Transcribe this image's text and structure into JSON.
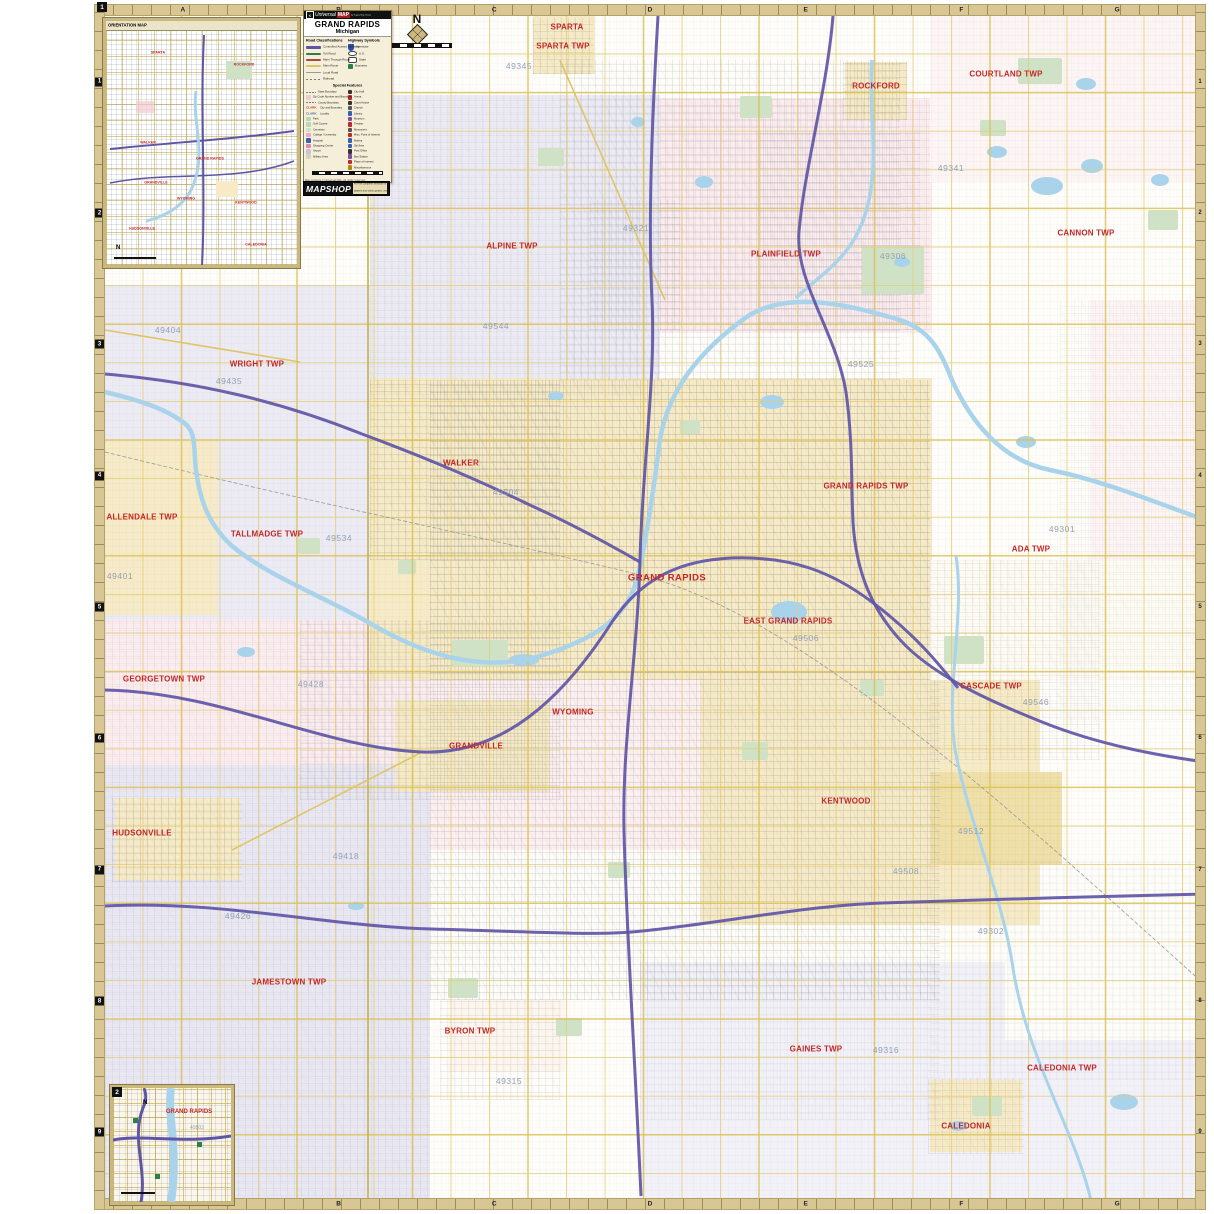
{
  "sheet": {
    "title": "GRAND RAPIDS",
    "subtitle": "Michigan",
    "brand": {
      "k": "K",
      "name": "Universal",
      "map": "MAP",
      "tag": "by Kappa Map Group"
    },
    "north_letter": "N",
    "grid": {
      "letters": [
        "A",
        "B",
        "C",
        "D",
        "E",
        "F",
        "G"
      ],
      "numbers": [
        "1",
        "2",
        "3",
        "4",
        "5",
        "6",
        "7",
        "8",
        "9"
      ]
    },
    "legend": {
      "roads_header": "Road Classifications",
      "symbols_header": "Highway Symbols",
      "roads": [
        {
          "label": "Controlled Access Highway",
          "color": "#5f55a6",
          "w": 3
        },
        {
          "label": "Toll Road",
          "color": "#2e7d4f",
          "w": 2
        },
        {
          "label": "Main Through Route",
          "color": "#a84b3c",
          "w": 2
        },
        {
          "label": "Main Route",
          "color": "#dfc566",
          "w": 2
        },
        {
          "label": "Local Road",
          "color": "#9a9a9a",
          "w": 1
        },
        {
          "label": "Railroad",
          "color": "#777777",
          "w": 1,
          "dash": true
        }
      ],
      "symbols": [
        {
          "label": "Interstate",
          "type": "shield"
        },
        {
          "label": "U.S.",
          "type": "oval"
        },
        {
          "label": "State",
          "type": "rect"
        },
        {
          "label": "Business",
          "type": "square"
        }
      ],
      "special_header": "Special Features",
      "special_left": [
        {
          "t": "State Boundary",
          "chip": "dash"
        },
        {
          "t": "Zip Code Number and Boundary",
          "chip": "#f3c9d3"
        },
        {
          "t": "County Boundary",
          "chip": "dash"
        },
        {
          "t": "City and Boundary",
          "chip": "text:#c42727:CLARK"
        },
        {
          "t": "Locality",
          "chip": "text:#3a5fae:CLARK"
        },
        {
          "t": "Park",
          "chip": "#b9d7ae"
        },
        {
          "t": "Golf Course",
          "chip": "#b9d7ae"
        },
        {
          "t": "Cemetery",
          "chip": "#cfe0c8"
        },
        {
          "t": "College / University",
          "chip": "#f0a7c3"
        },
        {
          "t": "Hospital",
          "chip": "#3a5fae"
        },
        {
          "t": "Shopping Center",
          "chip": "#e08aa8"
        },
        {
          "t": "Airport",
          "chip": "#c9bfe0"
        },
        {
          "t": "Military Area",
          "chip": "#d8d3b8"
        }
      ],
      "special_right": [
        {
          "t": "City Hall",
          "chip": "#333333"
        },
        {
          "t": "Arena",
          "chip": "#c42727"
        },
        {
          "t": "Court House",
          "chip": "#333333"
        },
        {
          "t": "Church",
          "chip": "#555555"
        },
        {
          "t": "Library",
          "chip": "#3a5fae"
        },
        {
          "t": "Museum",
          "chip": "#7a4fa0"
        },
        {
          "t": "Theater",
          "chip": "#c42727"
        },
        {
          "t": "Monument",
          "chip": "#555555"
        },
        {
          "t": "Misc. Point of Interest",
          "chip": "#c42727"
        },
        {
          "t": "Marina",
          "chip": "#3a5fae"
        },
        {
          "t": "Ski Area",
          "chip": "#3a5fae"
        },
        {
          "t": "Post Office",
          "chip": "#333333"
        },
        {
          "t": "Bus Station",
          "chip": "#7a4fa0"
        },
        {
          "t": "Place of Interest",
          "chip": "#c42727"
        },
        {
          "t": "Miscellaneous",
          "chip": "#b5890f"
        }
      ],
      "copyright": "Map contents © Universal Map. All rights reserved."
    },
    "mapshop": {
      "name": "MAPSHOP",
      "lines": [
        "For the complete selection of maps,",
        "atlases and travel guides, visit",
        "your local MapShop dealer."
      ]
    },
    "insets": {
      "orientation": {
        "tab": "1",
        "header": "ORIENTATION MAP",
        "labels": [
          {
            "t": "SPARTA",
            "x": 52,
            "y": 22
          },
          {
            "t": "ROCKFORD",
            "x": 138,
            "y": 34
          },
          {
            "t": "WALKER",
            "x": 42,
            "y": 112
          },
          {
            "t": "GRAND RAPIDS",
            "x": 104,
            "y": 128
          },
          {
            "t": "GRANDVILLE",
            "x": 50,
            "y": 152
          },
          {
            "t": "WYOMING",
            "x": 80,
            "y": 168
          },
          {
            "t": "KENTWOOD",
            "x": 140,
            "y": 172
          },
          {
            "t": "HUDSONVILLE",
            "x": 36,
            "y": 198
          },
          {
            "t": "CALEDONIA",
            "x": 150,
            "y": 214
          }
        ]
      },
      "downtown": {
        "tab": "2",
        "city": "GRAND RAPIDS",
        "zip": "49503",
        "north": "N"
      }
    },
    "places": [
      {
        "t": "SPARTA TWP",
        "x": 563,
        "y": 46
      },
      {
        "t": "SPARTA",
        "x": 567,
        "y": 27
      },
      {
        "t": "ROCKFORD",
        "x": 876,
        "y": 86
      },
      {
        "t": "COURTLAND TWP",
        "x": 1006,
        "y": 74
      },
      {
        "t": "CANNON TWP",
        "x": 1086,
        "y": 233
      },
      {
        "t": "PLAINFIELD TWP",
        "x": 786,
        "y": 254
      },
      {
        "t": "ALPINE TWP",
        "x": 512,
        "y": 246
      },
      {
        "t": "WRIGHT TWP",
        "x": 257,
        "y": 364
      },
      {
        "t": "ALLENDALE TWP",
        "x": 142,
        "y": 517
      },
      {
        "t": "TALLMADGE TWP",
        "x": 267,
        "y": 534
      },
      {
        "t": "WALKER",
        "x": 461,
        "y": 463
      },
      {
        "t": "GRAND RAPIDS TWP",
        "x": 866,
        "y": 486
      },
      {
        "t": "ADA TWP",
        "x": 1031,
        "y": 549
      },
      {
        "t": "GRAND RAPIDS",
        "x": 667,
        "y": 578,
        "big": true
      },
      {
        "t": "EAST GRAND RAPIDS",
        "x": 788,
        "y": 621
      },
      {
        "t": "CASCADE TWP",
        "x": 991,
        "y": 686
      },
      {
        "t": "GEORGETOWN TWP",
        "x": 164,
        "y": 679
      },
      {
        "t": "WYOMING",
        "x": 573,
        "y": 712
      },
      {
        "t": "GRANDVILLE",
        "x": 476,
        "y": 746
      },
      {
        "t": "KENTWOOD",
        "x": 846,
        "y": 801
      },
      {
        "t": "HUDSONVILLE",
        "x": 142,
        "y": 833
      },
      {
        "t": "JAMESTOWN TWP",
        "x": 289,
        "y": 982
      },
      {
        "t": "BYRON TWP",
        "x": 470,
        "y": 1031
      },
      {
        "t": "GAINES TWP",
        "x": 816,
        "y": 1049
      },
      {
        "t": "CALEDONIA TWP",
        "x": 1062,
        "y": 1068
      },
      {
        "t": "CALEDONIA",
        "x": 966,
        "y": 1126
      }
    ],
    "zips": [
      {
        "t": "49345",
        "x": 519,
        "y": 66
      },
      {
        "t": "49321",
        "x": 636,
        "y": 228
      },
      {
        "t": "49306",
        "x": 893,
        "y": 256
      },
      {
        "t": "49341",
        "x": 951,
        "y": 168
      },
      {
        "t": "49404",
        "x": 168,
        "y": 330
      },
      {
        "t": "49435",
        "x": 229,
        "y": 381
      },
      {
        "t": "49544",
        "x": 496,
        "y": 326
      },
      {
        "t": "49525",
        "x": 861,
        "y": 364
      },
      {
        "t": "49504",
        "x": 506,
        "y": 492
      },
      {
        "t": "49534",
        "x": 339,
        "y": 538
      },
      {
        "t": "49401",
        "x": 120,
        "y": 576
      },
      {
        "t": "49301",
        "x": 1062,
        "y": 529
      },
      {
        "t": "49506",
        "x": 806,
        "y": 638
      },
      {
        "t": "49546",
        "x": 1036,
        "y": 702
      },
      {
        "t": "49428",
        "x": 311,
        "y": 684
      },
      {
        "t": "49418",
        "x": 346,
        "y": 856
      },
      {
        "t": "49512",
        "x": 971,
        "y": 831
      },
      {
        "t": "49508",
        "x": 906,
        "y": 871
      },
      {
        "t": "49426",
        "x": 238,
        "y": 916
      },
      {
        "t": "49315",
        "x": 509,
        "y": 1081
      },
      {
        "t": "49316",
        "x": 886,
        "y": 1050
      },
      {
        "t": "49302",
        "x": 991,
        "y": 931
      }
    ]
  },
  "colors": {
    "frame": "#d8c795",
    "water": "#a9d3ea",
    "freeway": "#5f55a6",
    "main_road": "#e2cc74",
    "label_red": "#c42727",
    "zip_blue": "#93a0b5"
  }
}
